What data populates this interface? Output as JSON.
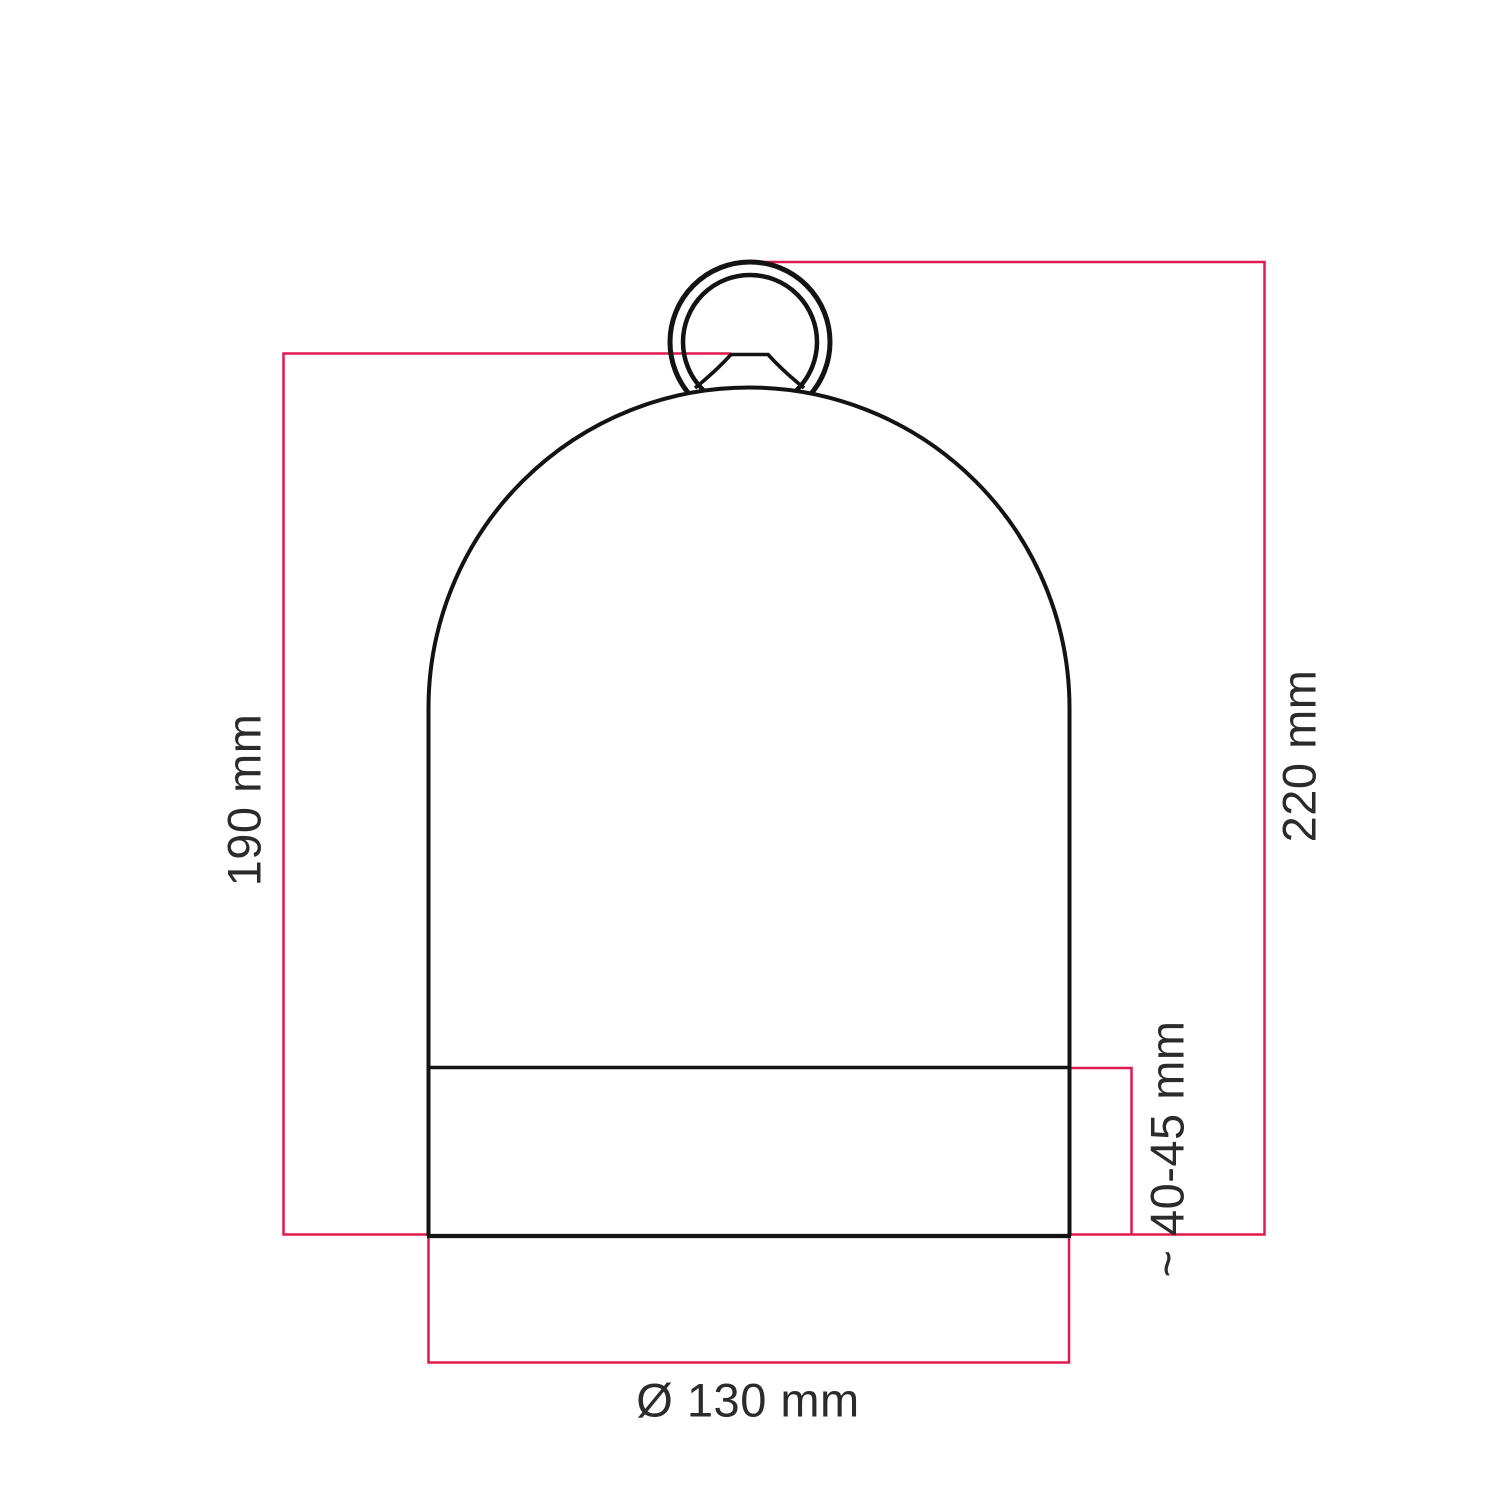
{
  "colors": {
    "background": "#ffffff",
    "dimension_red": "#e0194e",
    "outline_black": "#131313",
    "label_color": "#2b2b2b"
  },
  "dimension_labels": {
    "left_height": "190 mm",
    "right_height": "220 mm",
    "base_height": "~ 40-45 mm",
    "diameter": "Ø 130 mm"
  }
}
